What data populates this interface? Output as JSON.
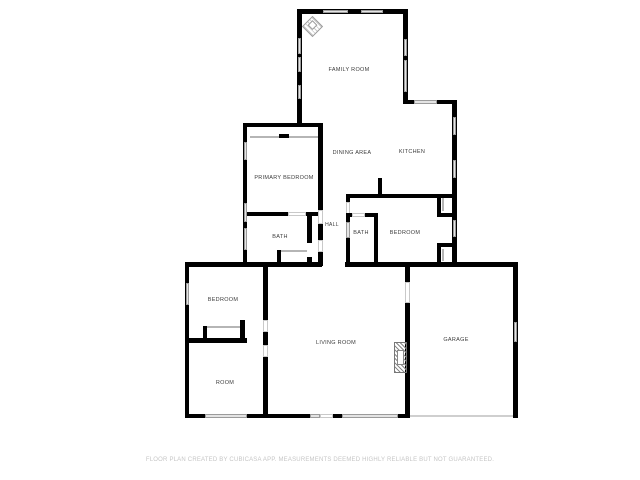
{
  "floorplan": {
    "rooms": [
      {
        "id": "family-room",
        "label": "FAMILY ROOM"
      },
      {
        "id": "dining-area",
        "label": "DINING AREA"
      },
      {
        "id": "kitchen",
        "label": "KITCHEN"
      },
      {
        "id": "primary-bedroom",
        "label": "PRIMARY BEDROOM"
      },
      {
        "id": "bath-left",
        "label": "BATH"
      },
      {
        "id": "hall",
        "label": "HALL"
      },
      {
        "id": "bath-right",
        "label": "BATH"
      },
      {
        "id": "bedroom-middle",
        "label": "BEDROOM"
      },
      {
        "id": "bedroom-lower",
        "label": "BEDROOM"
      },
      {
        "id": "living-room",
        "label": "LIVING ROOM"
      },
      {
        "id": "room",
        "label": "ROOM"
      },
      {
        "id": "garage",
        "label": "GARAGE"
      }
    ],
    "icons": [
      {
        "name": "compass-icon"
      }
    ],
    "disclaimer": "FLOOR PLAN CREATED BY CUBICASA APP. MEASUREMENTS DEEMED HIGHLY RELIABLE BUT NOT GUARANTEED.",
    "colors": {
      "background": "#ffffff",
      "wall": "#000000",
      "window_fill": "#e4e4e4",
      "window_border": "#9b9b9b",
      "door_border": "#c9c9c9",
      "label_text": "#3c3c3c",
      "disclaimer_text": "#c6c6c6"
    }
  }
}
